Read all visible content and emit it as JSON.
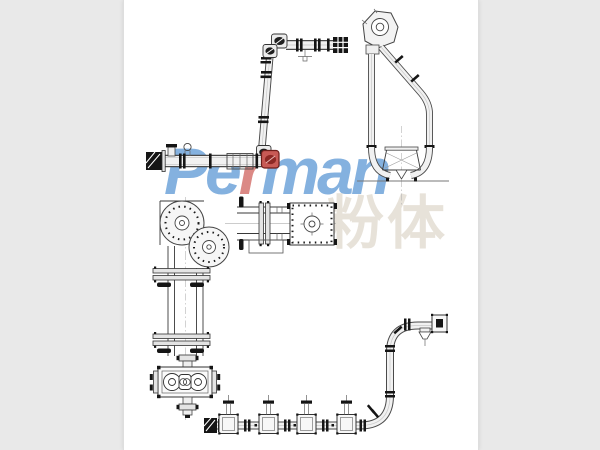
{
  "image": {
    "description": "Technical line-drawing collage of tube chain conveyor layouts on a white panel",
    "outer_background": "#e9e9e9",
    "panel_background": "#ffffff",
    "line_color": "#3a3a3a",
    "tube_fill": "#f1f1f1",
    "accent_red": "#c85a55",
    "brand_blue": "#6aa0d8"
  },
  "watermark": {
    "brand_full": "Perman",
    "brand_segments": [
      {
        "text": "Pe",
        "color": "#6aa0d8"
      },
      {
        "text": "r",
        "color": "#d4706b"
      },
      {
        "text": "man",
        "color": "#6aa0d8"
      }
    ],
    "cjk_text": "粉体",
    "cjk_color": "rgba(212,202,185,0.55)"
  },
  "diagram": {
    "components": [
      {
        "name": "top-z-elevator-conveyor"
      },
      {
        "name": "middle-horizontal-conveyor"
      },
      {
        "name": "right-loop-pipe-conveyor"
      },
      {
        "name": "corner-wheel-assembly-plan"
      },
      {
        "name": "vertical-conveyor-with-drive-unit"
      },
      {
        "name": "bottom-multi-inlet-s-curve-conveyor"
      }
    ]
  }
}
